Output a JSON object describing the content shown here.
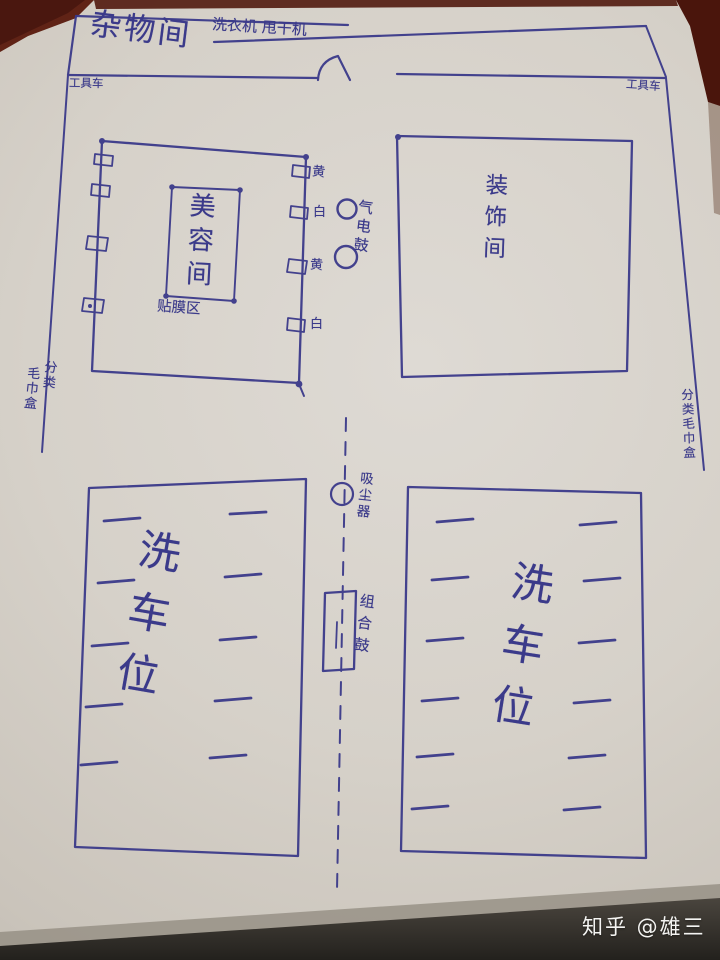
{
  "colors": {
    "ink": "#3b3a8a",
    "paper": "#d7d2ca",
    "table_wood": "#4a170f",
    "bottom_shadow": "#23211d",
    "watermark_text": "#f4f4f2"
  },
  "rooms": {
    "utility": {
      "label": "杂物间",
      "appliances": "洗衣机 甩干机"
    },
    "beauty": {
      "label": "美容间",
      "sub_label": "贴膜区"
    },
    "decoration": {
      "label": "装饰间"
    },
    "wash_bay_left": {
      "label": "洗车位"
    },
    "wash_bay_right": {
      "label": "洗车位"
    }
  },
  "equipment": {
    "tool_cart_left": "工具车",
    "tool_cart_right": "工具车",
    "hose_hooks": [
      "黄",
      "白",
      "黄",
      "白"
    ],
    "air_electric_reel": "气电鼓",
    "vacuum_cleaner": "吸尘器",
    "combo_reel": "组合鼓",
    "towel_sort_left_col1": "分类",
    "towel_sort_left_col2": "毛巾盒",
    "towel_sort_right": "分类毛巾盒"
  },
  "watermark": "知乎 @雄三"
}
